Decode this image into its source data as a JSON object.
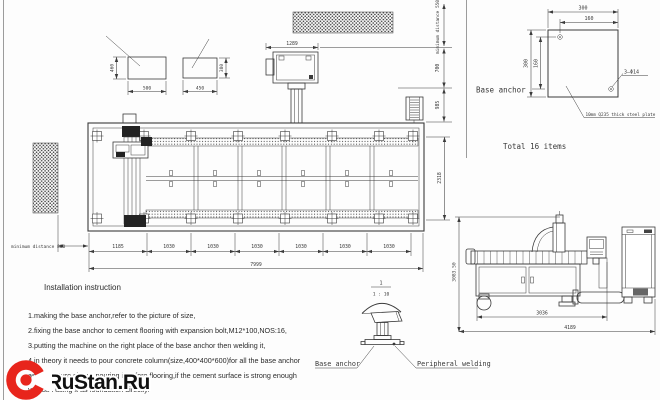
{
  "colors": {
    "line": "#3a3a3a",
    "dark": "#222222",
    "red": "#e8251c"
  },
  "watermark": {
    "brand": "RuStan.Ru"
  },
  "right_panel": {
    "label": "Base anchor",
    "total": "Total 16 items",
    "dim_width_outer": "300",
    "dim_width_inner": "160",
    "dim_height_outer": "300",
    "dim_height_inner": "160",
    "hole_note": "3—Φ14",
    "plate_note": "10mm Q235 thick steel plate"
  },
  "anchor_blocks": {
    "block1": {
      "width": "500",
      "height": "460"
    },
    "block2": {
      "width": "450",
      "height": "380"
    }
  },
  "top_area": {
    "dim_beam": "1289",
    "min_distance_top": "minimum distance 550",
    "dim_700": "700",
    "dim_985": "985"
  },
  "plan_view": {
    "dim_depth": "2318",
    "segments": [
      "1185",
      "1030",
      "1030",
      "1030",
      "1030",
      "1030",
      "1030"
    ],
    "dim_total": "7999",
    "min_distance_left": "minimum distance 800"
  },
  "side_view": {
    "dim_height": "3083.50",
    "dim_width_inner": "3036",
    "dim_width_outer": "4189"
  },
  "foot_detail": {
    "scale_numerator": "1",
    "scale_denominator": "1 : 10",
    "label_base_anchor": "Base anchor",
    "label_welding": "Peripheral welding"
  },
  "instructions": {
    "title": "Installation instruction",
    "line1": "1.making the base anchor,refer to the picture of size,",
    "line2": "2.fixing the base anchor to cement flooring with expansion bolt,M12*100,NOS:16,",
    "line3": "3.putting the machine on the right place of the base anchor then welding it,",
    "line4": "4.in theory it needs to pour concrete column(size,400*400*600)for all the base anchor",
    "line5": "as the picture shows,pouring it before flooring,if the cement surface is strong enough",
    "line6": "you can using it as foundation directly."
  }
}
